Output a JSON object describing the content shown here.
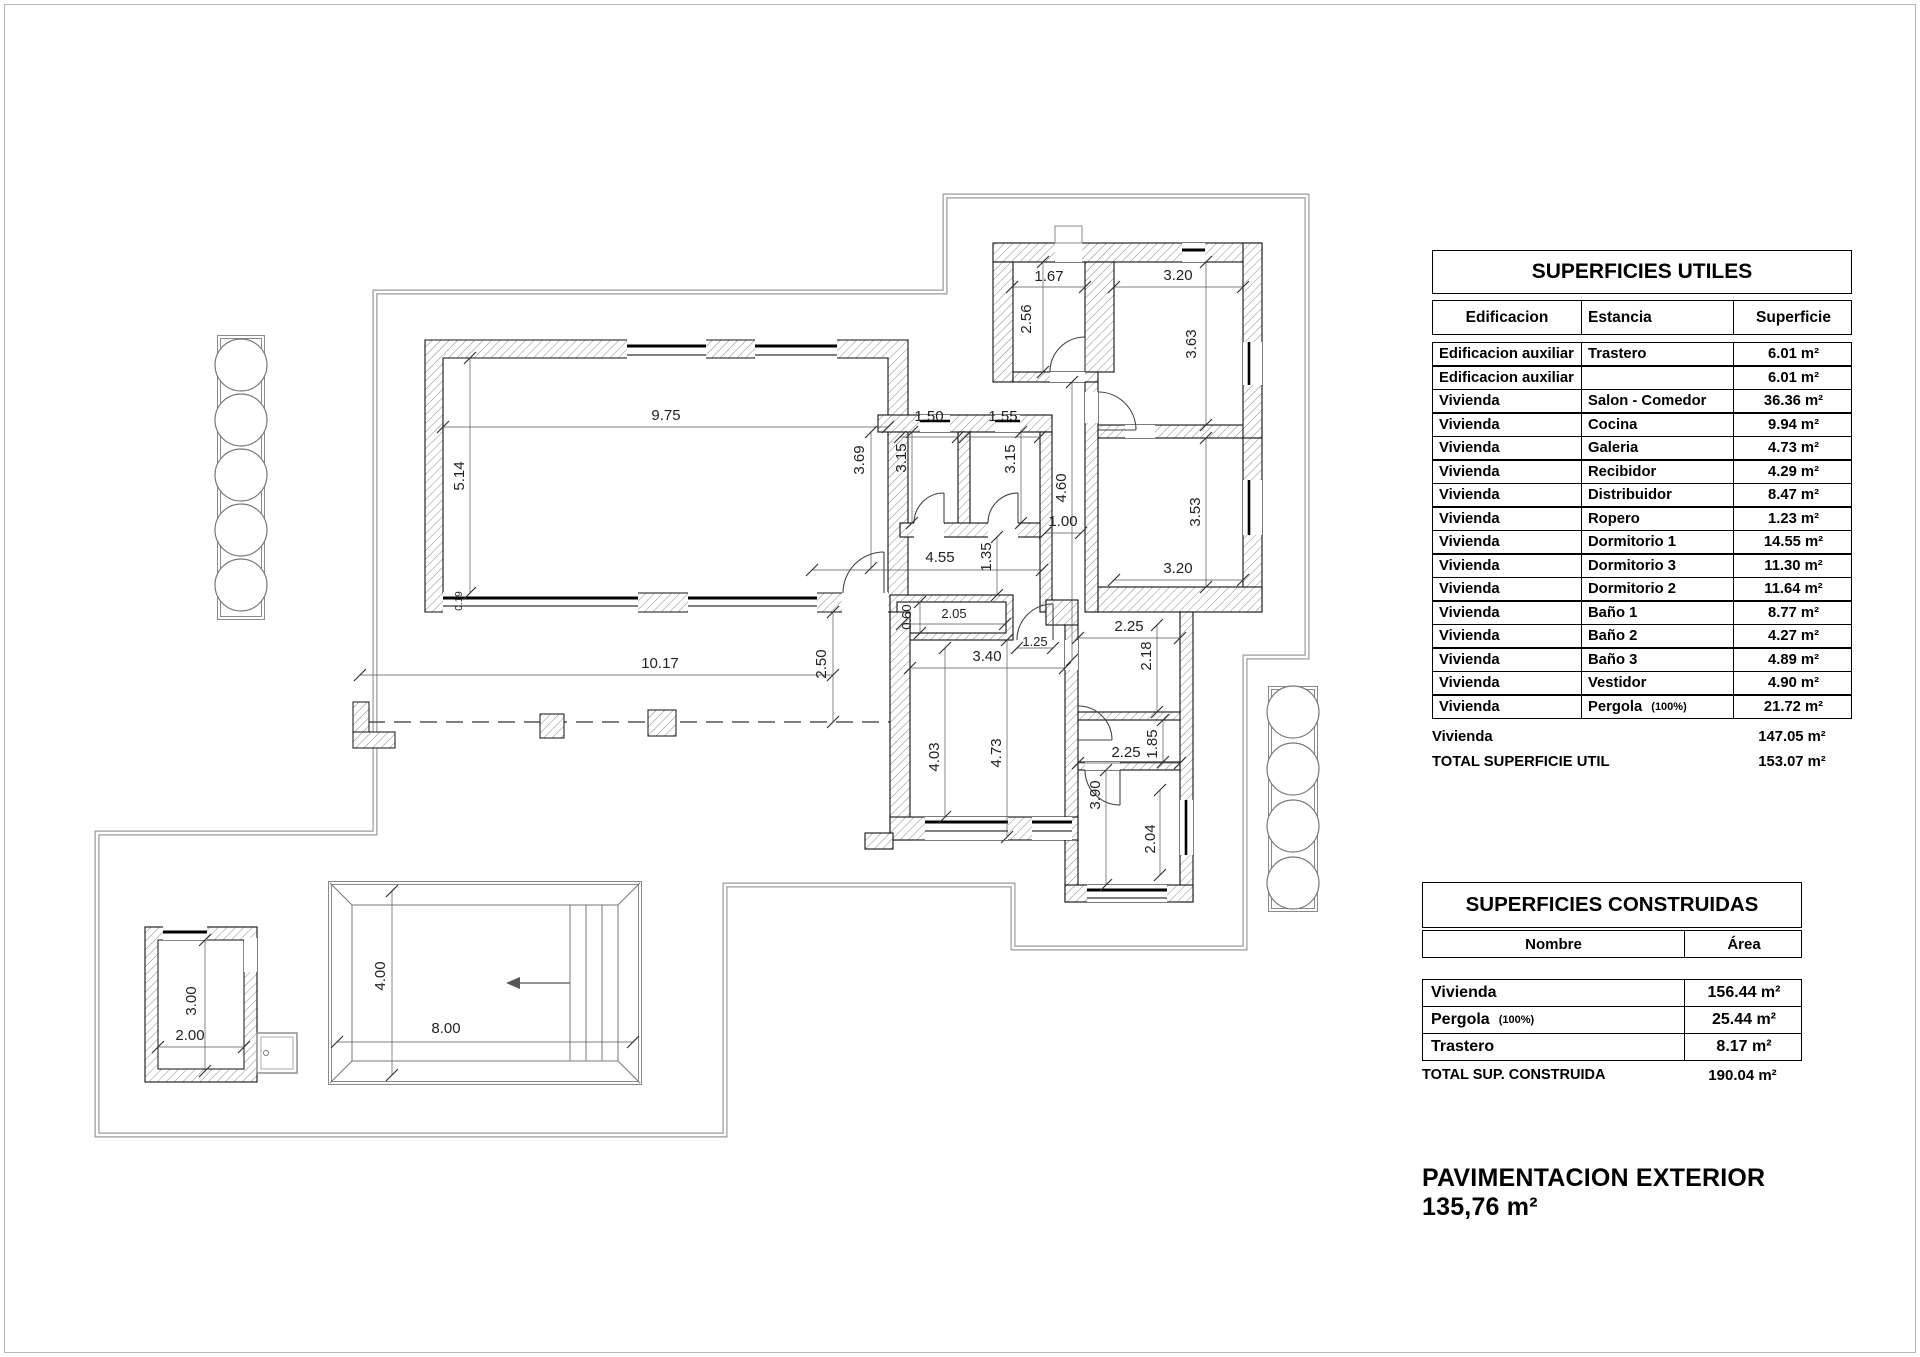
{
  "tables": {
    "utiles": {
      "title": "SUPERFICIES UTILES",
      "col_edificacion": "Edificacion",
      "col_estancia": "Estancia",
      "col_superficie": "Superficie",
      "rows": [
        {
          "edificacion": "Edificacion auxiliar",
          "estancia": "Trastero",
          "nota": "",
          "sup": "6.01 m²"
        },
        {
          "edificacion": "Edificacion auxiliar",
          "estancia": "",
          "nota": "",
          "sup": "6.01 m²"
        },
        {
          "edificacion": "Vivienda",
          "estancia": "Salon - Comedor",
          "nota": "",
          "sup": "36.36 m²"
        },
        {
          "edificacion": "Vivienda",
          "estancia": "Cocina",
          "nota": "",
          "sup": "9.94 m²"
        },
        {
          "edificacion": "Vivienda",
          "estancia": "Galeria",
          "nota": "",
          "sup": "4.73 m²"
        },
        {
          "edificacion": "Vivienda",
          "estancia": "Recibidor",
          "nota": "",
          "sup": "4.29 m²"
        },
        {
          "edificacion": "Vivienda",
          "estancia": "Distribuidor",
          "nota": "",
          "sup": "8.47 m²"
        },
        {
          "edificacion": "Vivienda",
          "estancia": "Ropero",
          "nota": "",
          "sup": "1.23 m²"
        },
        {
          "edificacion": "Vivienda",
          "estancia": "Dormitorio 1",
          "nota": "",
          "sup": "14.55 m²"
        },
        {
          "edificacion": "Vivienda",
          "estancia": "Dormitorio 3",
          "nota": "",
          "sup": "11.30 m²"
        },
        {
          "edificacion": "Vivienda",
          "estancia": "Dormitorio 2",
          "nota": "",
          "sup": "11.64 m²"
        },
        {
          "edificacion": "Vivienda",
          "estancia": "Baño 1",
          "nota": "",
          "sup": "8.77 m²"
        },
        {
          "edificacion": "Vivienda",
          "estancia": "Baño 2",
          "nota": "",
          "sup": "4.27 m²"
        },
        {
          "edificacion": "Vivienda",
          "estancia": "Baño 3",
          "nota": "",
          "sup": "4.89 m²"
        },
        {
          "edificacion": "Vivienda",
          "estancia": "Vestidor",
          "nota": "",
          "sup": "4.90 m²"
        },
        {
          "edificacion": "Vivienda",
          "estancia": "Pergola",
          "nota": "(100%)",
          "sup": "21.72 m²"
        }
      ],
      "summary": [
        {
          "label": "Vivienda",
          "sup": "147.05 m²"
        },
        {
          "label": "TOTAL SUPERFICIE UTIL",
          "sup": "153.07 m²"
        }
      ]
    },
    "construidas": {
      "title": "SUPERFICIES CONSTRUIDAS",
      "col_nombre": "Nombre",
      "col_area": "Área",
      "rows": [
        {
          "nombre": "Vivienda",
          "nota": "",
          "area": "156.44 m²"
        },
        {
          "nombre": "Pergola",
          "nota": "(100%)",
          "area": "25.44 m²"
        },
        {
          "nombre": "Trastero",
          "nota": "",
          "area": "8.17 m²"
        }
      ],
      "total": {
        "label": "TOTAL SUP. CONSTRUIDA",
        "area": "190.04 m²"
      }
    }
  },
  "footer": {
    "text": "PAVIMENTACION EXTERIOR 135,76 m²"
  },
  "plan": {
    "dims": [
      {
        "t": "9.75",
        "x": 666,
        "y": 420,
        "r": 0
      },
      {
        "t": "5.14",
        "x": 464,
        "y": 476,
        "r": 1
      },
      {
        "t": "0.19",
        "x": 462,
        "y": 601,
        "r": 1,
        "s": 10
      },
      {
        "t": "3.69",
        "x": 864,
        "y": 460,
        "r": 1
      },
      {
        "t": "1.50",
        "x": 929,
        "y": 421,
        "r": 0
      },
      {
        "t": "1.55",
        "x": 1003,
        "y": 421,
        "r": 0
      },
      {
        "t": "3.15",
        "x": 906,
        "y": 458,
        "r": 1
      },
      {
        "t": "3.15",
        "x": 1015,
        "y": 459,
        "r": 1
      },
      {
        "t": "1.67",
        "x": 1049,
        "y": 281,
        "r": 0
      },
      {
        "t": "2.56",
        "x": 1031,
        "y": 319,
        "r": 1
      },
      {
        "t": "3.20",
        "x": 1178,
        "y": 280,
        "r": 0
      },
      {
        "t": "3.63",
        "x": 1196,
        "y": 344,
        "r": 1
      },
      {
        "t": "4.60",
        "x": 1066,
        "y": 488,
        "r": 1
      },
      {
        "t": "1.00",
        "x": 1063,
        "y": 526,
        "r": 0
      },
      {
        "t": "3.53",
        "x": 1200,
        "y": 512,
        "r": 1
      },
      {
        "t": "3.20",
        "x": 1178,
        "y": 573,
        "r": 0
      },
      {
        "t": "4.55",
        "x": 940,
        "y": 562,
        "r": 0
      },
      {
        "t": "1.35",
        "x": 991,
        "y": 557,
        "r": 1
      },
      {
        "t": "2.05",
        "x": 954,
        "y": 618,
        "r": 0,
        "s": 13
      },
      {
        "t": "0.60",
        "x": 911,
        "y": 617,
        "r": 1,
        "s": 13
      },
      {
        "t": "1.25",
        "x": 1035,
        "y": 646,
        "r": 0,
        "s": 13
      },
      {
        "t": "2.25",
        "x": 1129,
        "y": 631,
        "r": 0
      },
      {
        "t": "2.18",
        "x": 1151,
        "y": 656,
        "r": 1
      },
      {
        "t": "2.25",
        "x": 1126,
        "y": 757,
        "r": 0
      },
      {
        "t": "1.85",
        "x": 1157,
        "y": 744,
        "r": 1
      },
      {
        "t": "3.90",
        "x": 1100,
        "y": 795,
        "r": 1
      },
      {
        "t": "2.04",
        "x": 1155,
        "y": 839,
        "r": 1
      },
      {
        "t": "3.40",
        "x": 987,
        "y": 661,
        "r": 0
      },
      {
        "t": "4.03",
        "x": 939,
        "y": 757,
        "r": 1
      },
      {
        "t": "4.73",
        "x": 1001,
        "y": 753,
        "r": 1
      },
      {
        "t": "10.17",
        "x": 660,
        "y": 668,
        "r": 0
      },
      {
        "t": "2.50",
        "x": 826,
        "y": 664,
        "r": 1
      },
      {
        "t": "4.00",
        "x": 385,
        "y": 976,
        "r": 1
      },
      {
        "t": "8.00",
        "x": 446,
        "y": 1033,
        "r": 0
      },
      {
        "t": "3.00",
        "x": 196,
        "y": 1001,
        "r": 1
      },
      {
        "t": "2.00",
        "x": 190,
        "y": 1040,
        "r": 0
      }
    ]
  }
}
